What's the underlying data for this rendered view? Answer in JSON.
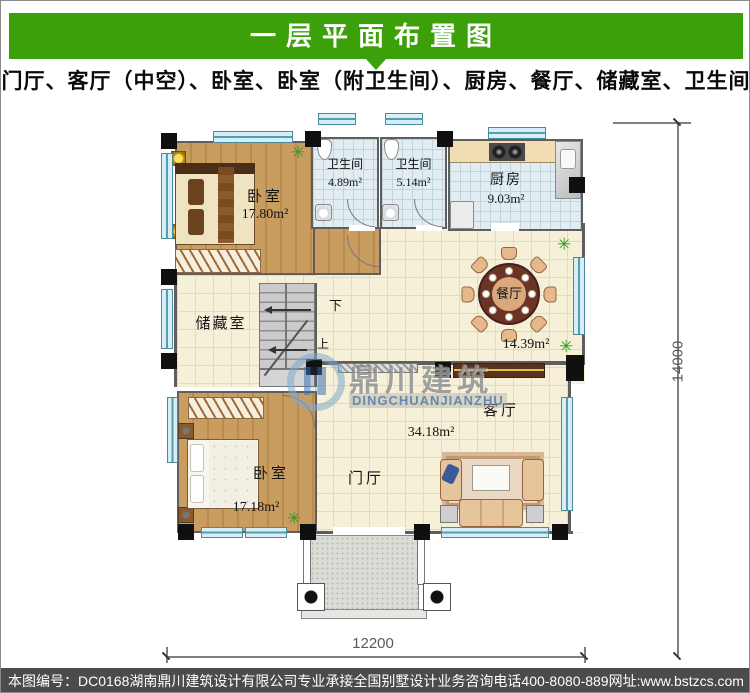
{
  "theme": {
    "accent_green": "#3BA00A",
    "footer_bg": "#4B4B4B",
    "window_blue": "#D6EEF6",
    "wood_brown": "#C49A5E"
  },
  "header": {
    "title": "一层平面布置图",
    "subtitle": "门厅、客厅（中空）、卧室、卧室（附卫生间）、厨房、餐厅、储藏室、卫生间"
  },
  "plan": {
    "rooms": {
      "bedroom_top": {
        "name": "卧室",
        "area": "17.80m²"
      },
      "bath_a": {
        "name": "卫生间",
        "area": "4.89m²"
      },
      "bath_b": {
        "name": "卫生间",
        "area": "5.14m²"
      },
      "kitchen": {
        "name": "厨房",
        "area": "9.03m²"
      },
      "dining": {
        "name": "餐厅",
        "area": "14.39m²"
      },
      "storage": {
        "name": "储藏室"
      },
      "bedroom_bottom": {
        "name": "卧室",
        "area": "17.18m²"
      },
      "foyer": {
        "name": "门厅"
      },
      "living": {
        "name": "客厅",
        "area": "34.18m²"
      }
    },
    "stairs": {
      "down_label": "下",
      "up_label": "上"
    },
    "dimensions": {
      "width_label": "12200",
      "height_label": "14000"
    }
  },
  "icons": {
    "plant": "✳"
  },
  "watermark": {
    "logo_cn": "鼎川建筑",
    "logo_en": "DINGCHUANJIANZHU"
  },
  "footer": {
    "drawing_no": "本图编号：DC0168",
    "company": "湖南鼎川建筑设计有限公司专业承接全国别墅设计业务",
    "phone": "咨询电话400-8080-889",
    "website": "网址:www.bstzcs.com"
  }
}
